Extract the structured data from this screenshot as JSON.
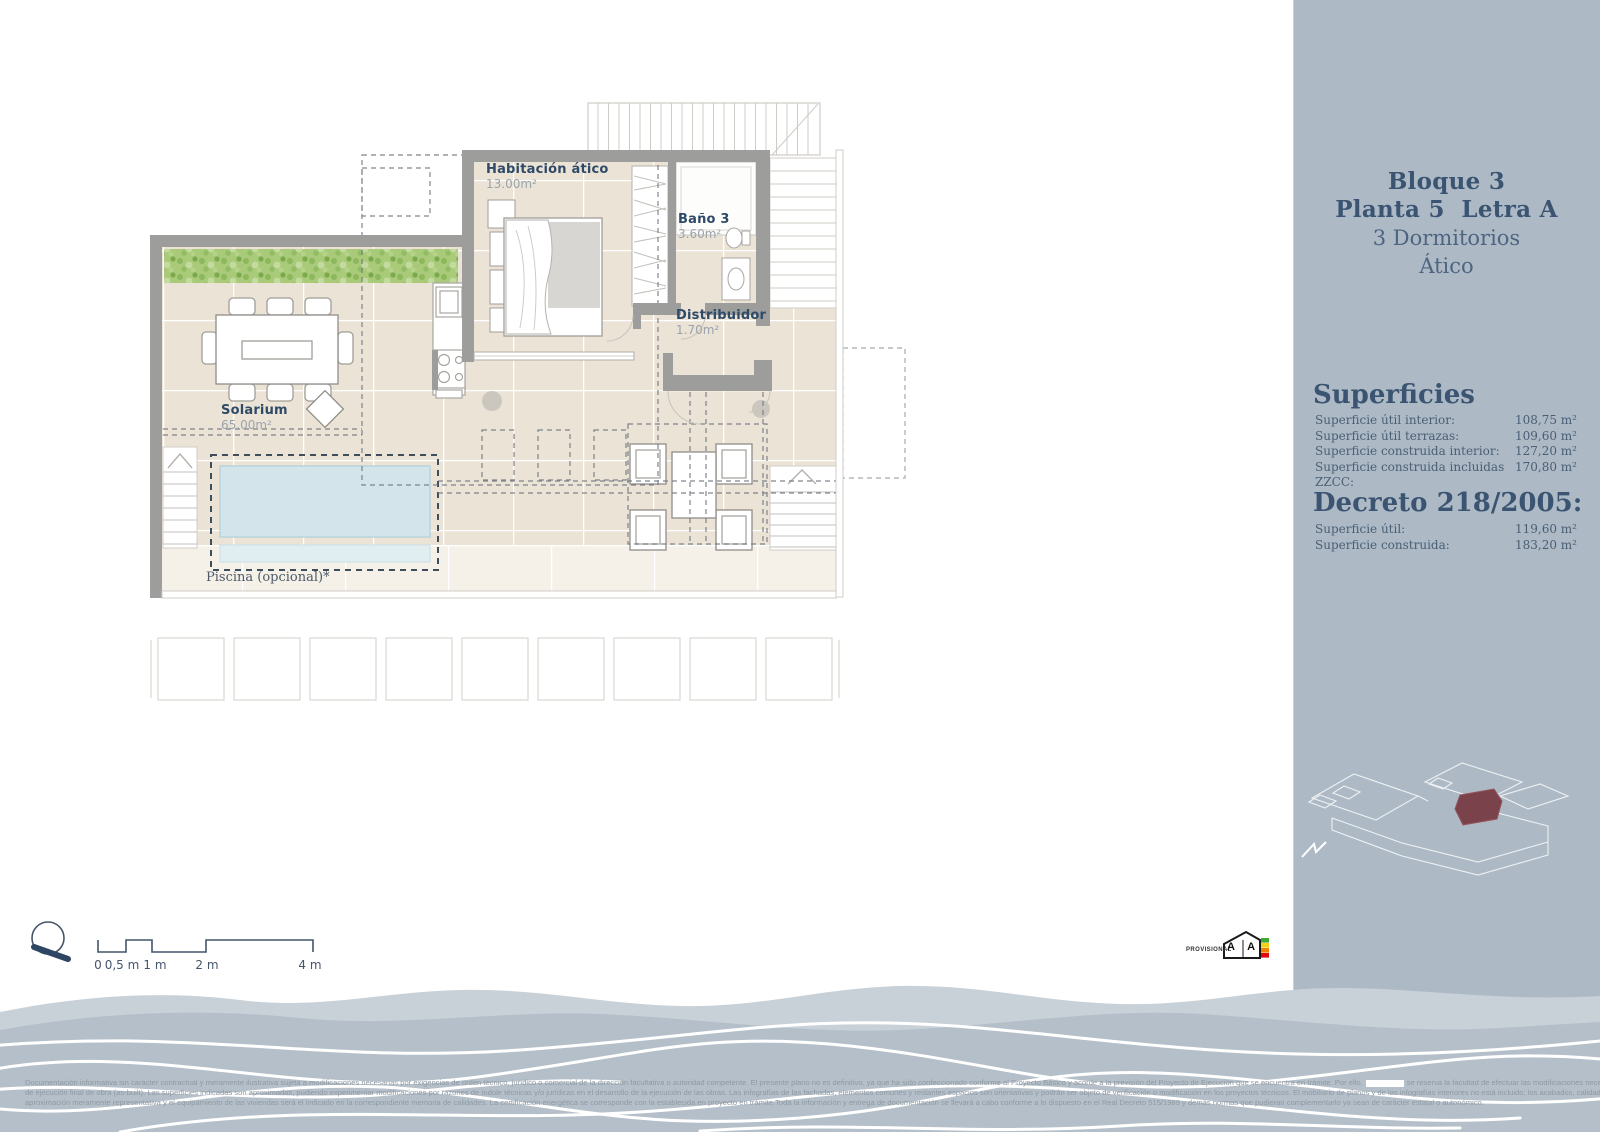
{
  "sidebar": {
    "title": {
      "line1": "Bloque 3",
      "line2": "Planta 5  Letra A",
      "line3": "3 Dormitorios",
      "line4": "Ático"
    },
    "superficies": {
      "heading": "Superficies",
      "rows": [
        {
          "label": "Superficie útil interior:",
          "value": "108,75 m²"
        },
        {
          "label": "Superficie útil terrazas:",
          "value": "109,60 m²"
        },
        {
          "label": "Superficie construida interior:",
          "value": "127,20 m²"
        },
        {
          "label": "Superficie construida incluidas ZZCC:",
          "value": "170,80 m²"
        }
      ]
    },
    "decreto": {
      "heading": "Decreto 218/2005:",
      "rows": [
        {
          "label": "Superficie útil:",
          "value": "119,60 m²"
        },
        {
          "label": "Superficie construida:",
          "value": "183,20 m²"
        }
      ]
    }
  },
  "plan": {
    "rooms": {
      "habitacion": {
        "name": "Habitación ático",
        "area": "13.00m²"
      },
      "bano": {
        "name": "Baño 3",
        "area": "3.60m²"
      },
      "distribuidor": {
        "name": "Distribuidor",
        "area": "1.70m²"
      },
      "solarium": {
        "name": "Solarium",
        "area": "65.00m²"
      }
    },
    "pool_label": "Piscina (opcional)*"
  },
  "scale_bar": {
    "labels": [
      "0",
      "0,5 m",
      "1 m",
      "2 m",
      "4 m"
    ]
  },
  "footer": {
    "provisional": "PROVISIONAL",
    "energy_text": "A A"
  },
  "disclaimer": {
    "line1_a": "Documentación informativa sin carácter contractual y meramente ilustrativa sujeta a modificaciones necesarias por exigencias de orden técnico, jurídico o comercial de la dirección facultativa o autoridad competente. El presente plano no es definitivo, ya que ha sido confeccionado conforme al Proyecto Básico y acorde a la previsión del Proyecto de Ejecución que se encuentra en trámite. Por ello,",
    "line1_b": "se reserva la facultad de efectuar las modificaciones necesarias por exigencias técnicas y/o jurídicas, ajustándose, en todo caso, al proyecto",
    "line2": "de ejecución final de obra (as-built). Las superficies indicadas son aproximadas, pudiendo experimentar modificaciones por razones de índole técnicas y/o jurídicas en el desarrollo de la ejecución de las obras. Las infografías de las fachadas, elementos comunes y restantes espacios son orientativas y podrán ser objeto de verificación o modificación en los proyectos técnicos. El mobiliario de planos y de las infografías interiores no está incluido; los acabados, calidades, colores, equipamiento, aparatos sanitarios y muebles de cocina son una",
    "line3": "aproximación meramente representativa y el equipamiento de las viviendas será el indicado en la correspondiente memoria de calidades. La certificación energética se corresponde con la establecida en proyecto en trámite.Toda la información y entrega de documentación se llevará a cabo conforme a lo dispuesto en el Real Decreto 515/1989 y demás normas que pudieran complementarlo ya sean de carácter estatal o autonómico."
  },
  "colors": {
    "sidebar_bg": "#adbac6",
    "heading_text": "#3b5472",
    "wall": "#9d9d9b",
    "tile": "#ebe3d5",
    "pool_water": "#d3e5eb",
    "hedge_green": "#a9cb79",
    "wave_bg": "#b4bfc9",
    "highlight_unit_red": "#7a434b"
  }
}
